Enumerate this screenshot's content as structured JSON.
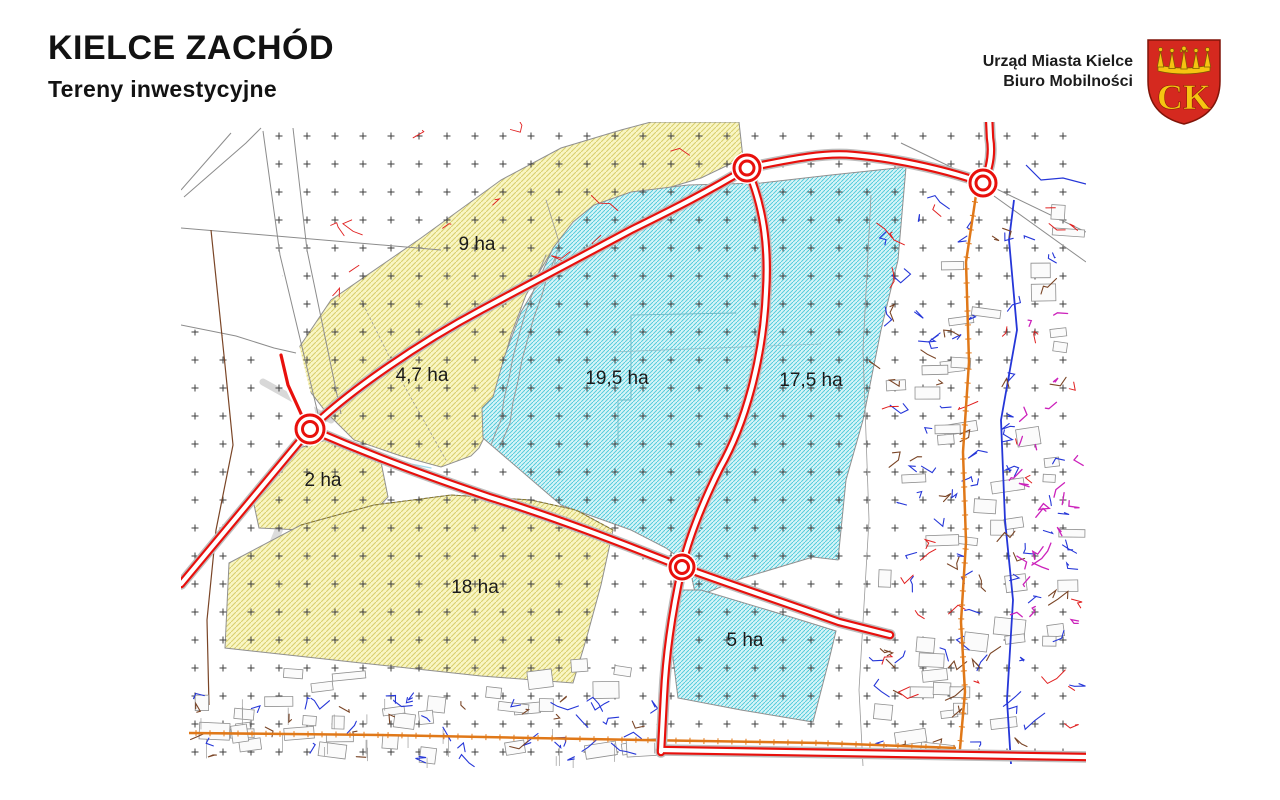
{
  "header": {
    "title": "KIELCE ZACHÓD",
    "subtitle": "Tereny inwestycyjne",
    "org_line1": "Urząd Miasta Kielce",
    "org_line2": "Biuro Mobilności",
    "logo_text": "CK"
  },
  "map": {
    "areas": [
      {
        "id": "9ha",
        "label": "9 ha",
        "zone": "yellow",
        "x": 296,
        "y": 128
      },
      {
        "id": "4-7ha",
        "label": "4,7 ha",
        "zone": "yellow",
        "x": 241,
        "y": 259
      },
      {
        "id": "19-5ha",
        "label": "19,5 ha",
        "zone": "cyan",
        "x": 436,
        "y": 262
      },
      {
        "id": "17-5ha",
        "label": "17,5 ha",
        "zone": "cyan",
        "x": 630,
        "y": 264
      },
      {
        "id": "2ha",
        "label": "2 ha",
        "zone": "yellow",
        "x": 142,
        "y": 364
      },
      {
        "id": "18ha",
        "label": "18 ha",
        "zone": "yellow",
        "x": 294,
        "y": 471
      },
      {
        "id": "5ha",
        "label": "5 ha",
        "zone": "cyan",
        "x": 564,
        "y": 524
      }
    ],
    "colors": {
      "road": "#e8100c",
      "zone_yellow_fill": "#f9f6c4",
      "zone_yellow_hatch": "#d9cf6e",
      "zone_cyan_fill": "#d6f4f7",
      "zone_cyan_hatch": "#49c9da",
      "utility_orange": "#e07818",
      "utility_blue": "#2536d8",
      "utility_brown": "#7a4526",
      "utility_magenta": "#cc22bb",
      "parcel": "#8c8c8c",
      "logo_red": "#d5291f",
      "logo_gold": "#f6c411"
    }
  }
}
